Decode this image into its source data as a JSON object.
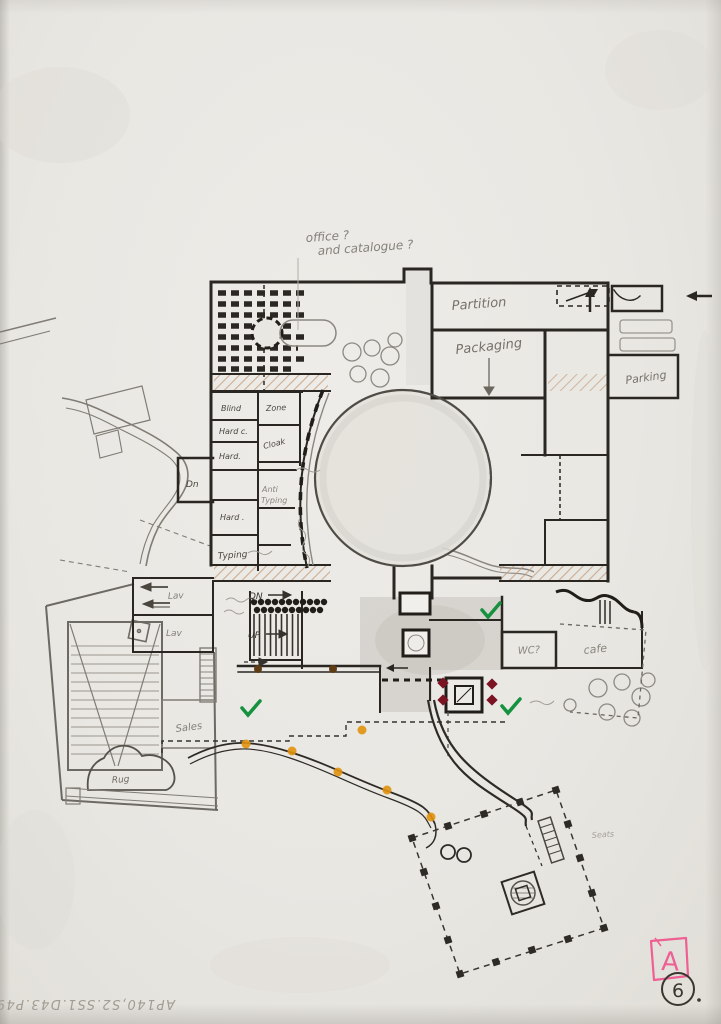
{
  "document_kind": "hand-drawn floor plan sketch",
  "colors": {
    "paper": "#e9e7e2",
    "ink": "#2a2723",
    "pencil": "#8b8780",
    "wall_hatch": "#c09877",
    "orange_dot": "#e1920e",
    "brown_dot": "#5f3b14",
    "dark_red_mark": "#7c1322",
    "green_check": "#15913f",
    "pink_marker": "#ee5f93"
  },
  "stamps": {
    "grade_letter": "A",
    "sheet_number": "6",
    "reference_code": "AP140,S2.SS1.D43.P49"
  },
  "annotations": {
    "office_query_line1": "office ?",
    "office_query_line2": "and catalogue ?",
    "partition": "Partition",
    "packaging": "Packaging",
    "parking": "Parking",
    "down": "Dn",
    "stair_down": "DN",
    "stair_up": "UP",
    "lavatory_upper": "Lav",
    "lavatory_lower": "Lav",
    "sales": "Sales",
    "rug": "Rug",
    "wc": "WC?",
    "cafe": "cafe",
    "seats": "Seats",
    "rooms": {
      "blind": "Blind",
      "hard_copy": "Hard c.",
      "hard": "Hard.",
      "zone": "Zone",
      "cloak": "Cloak",
      "anti_line1": "Anti",
      "anti_line2": "Typing",
      "hard_2": "Hard .",
      "typing": "Typing"
    }
  },
  "symbols": {
    "check": "✓",
    "entry_arrow": "←"
  }
}
